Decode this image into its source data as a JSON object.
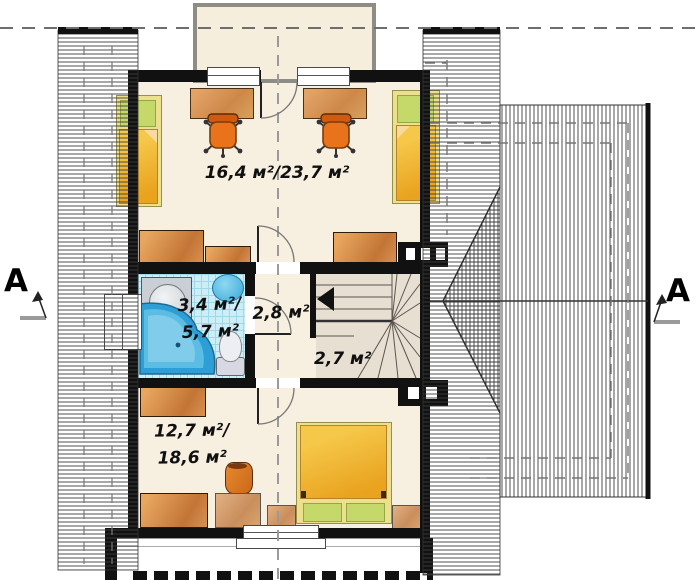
{
  "areas": {
    "top_room": "16,4 м²/23,7 м²",
    "bathroom": [
      "3,4 м²/",
      "5,7 м²"
    ],
    "hall": "2,8 м²",
    "stairs": "2,7 м²",
    "bottom_room": [
      "12,7 м²/",
      "18,6 м²"
    ]
  },
  "section_markers": {
    "left": "A",
    "right": "A"
  },
  "colors": {
    "wall": "#111111",
    "floor": "#f7efe0",
    "bath_tile": "#cdeef6",
    "bath_tile_grid": "#9fd8e8",
    "furniture_orange": "#e0812e",
    "desk_tan": "#d9995c",
    "bed_yellow": "#f3c340",
    "pillow_green": "#c5d96a",
    "tub_blue": "#2e9fd6",
    "stairs_beige": "#e7dfd2",
    "roof_hatch_line": "#3c3c3c",
    "dashed_axis": "#8a8a8a"
  },
  "legend_icons": [
    "bed",
    "desk",
    "office-chair",
    "wardrobe",
    "dresser",
    "corner-bathtub",
    "washbasin",
    "sink",
    "toilet",
    "double-bed",
    "nightstand",
    "stool",
    "winder-stairs",
    "balcony"
  ]
}
